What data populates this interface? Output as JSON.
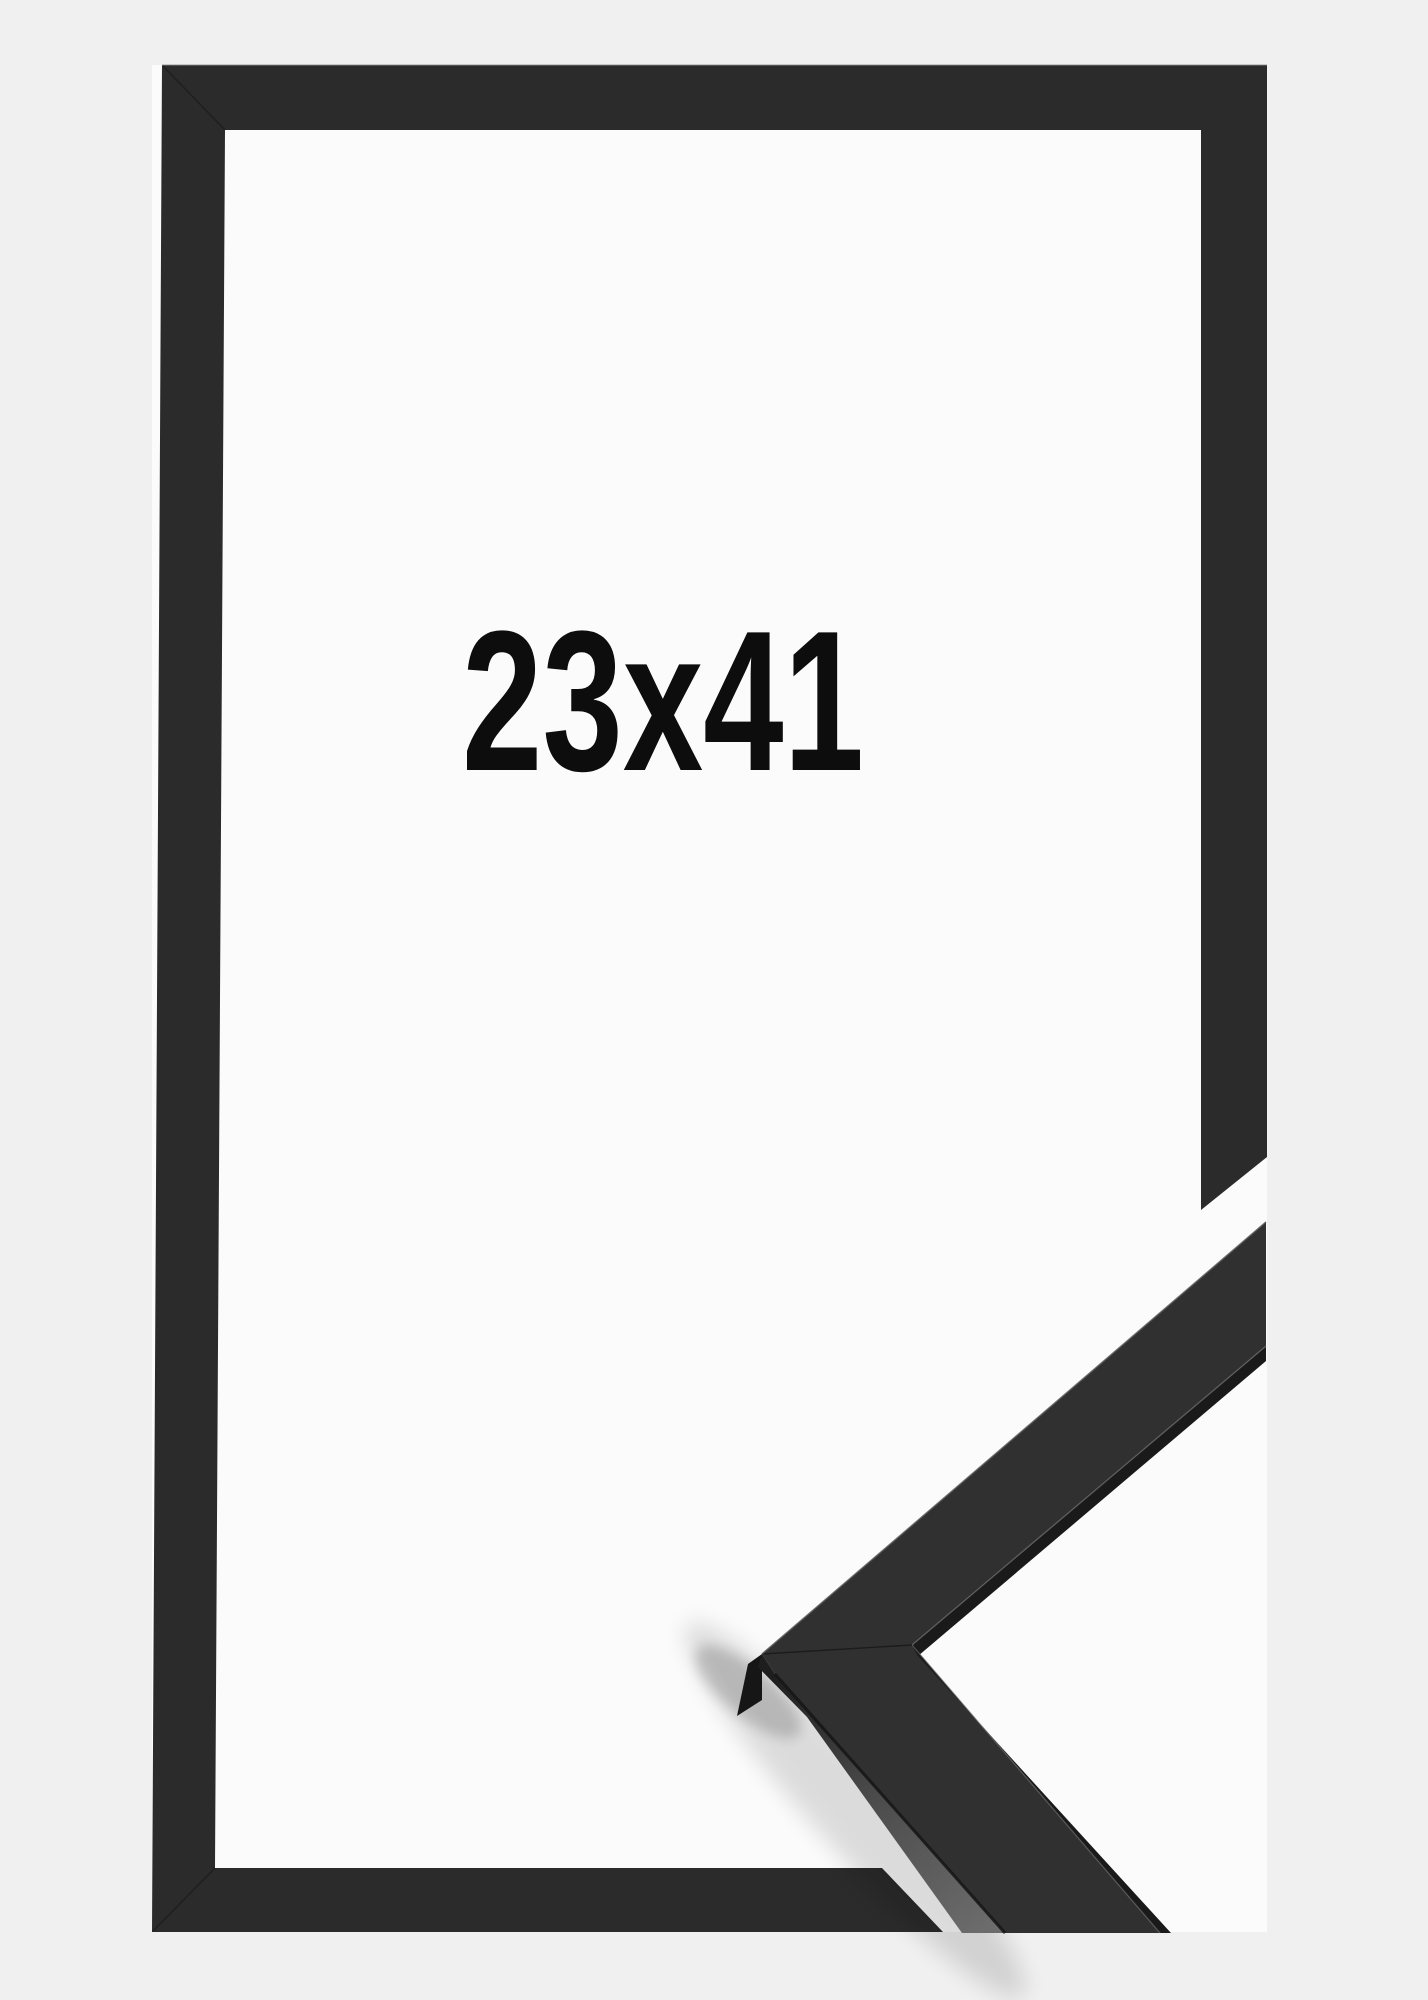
{
  "product": {
    "size_label": "23x41",
    "colors": {
      "page_background": "#f0f0f1",
      "frame_interior": "#fbfbfb",
      "frame_front": "#2b2b2b",
      "sample_top_face": "#303030",
      "sample_inner_face": "#1a1a1a",
      "text": "#0d0d0d"
    }
  }
}
